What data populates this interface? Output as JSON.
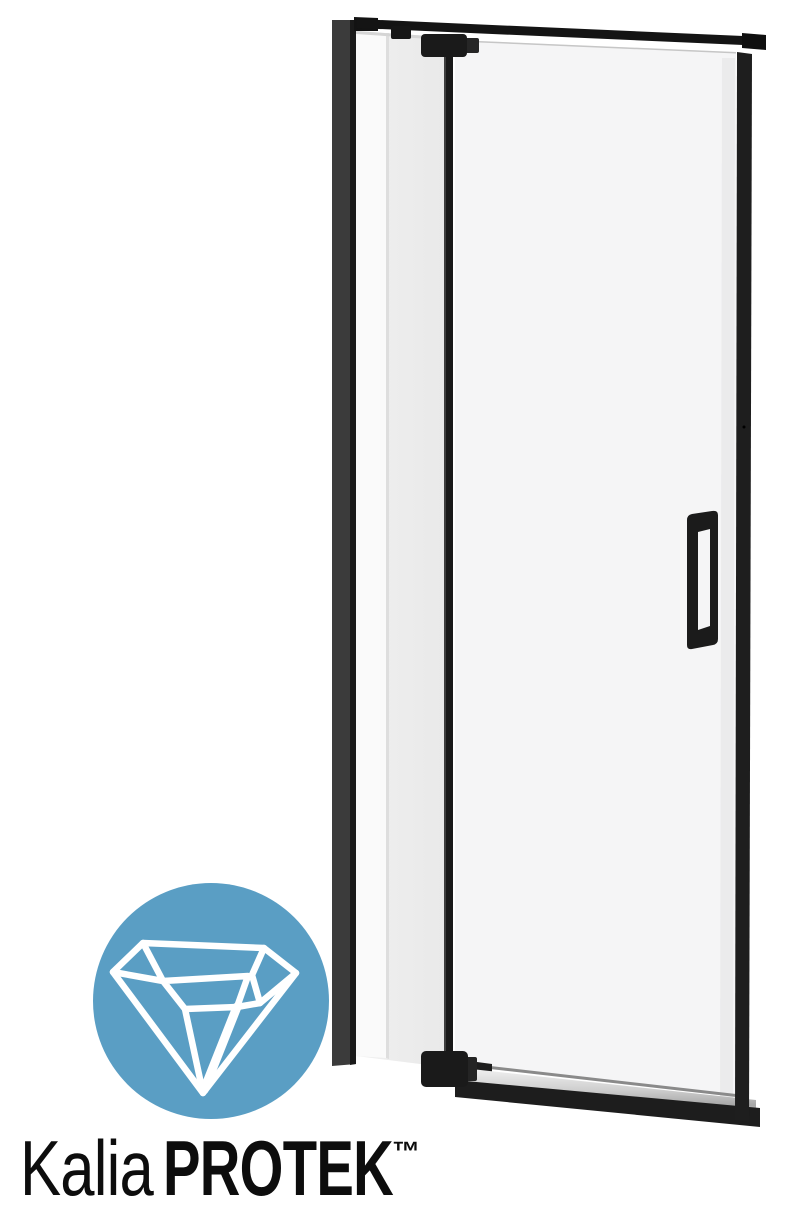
{
  "page": {
    "background": "#FFFFFF"
  },
  "brand": {
    "wordmark_regular": "Kalia",
    "wordmark_bold": "PROTEK",
    "trademark": "™"
  },
  "colors": {
    "background": "#FFFFFF",
    "frame_black": "#1E1E1E",
    "bar_black": "#141414",
    "hardware_black": "#1A1A1A",
    "handle_black": "#1B1B1B",
    "pivot_black": "#191919",
    "wall_profile_gray": "#3B3B3B",
    "door_glass": "#F5F5F6",
    "fixed_glass": "#ECECEC",
    "glass_highlight": "#FAFAFA",
    "threshold_black": "#1D1D1D",
    "badge_blue": "#5A9EC4",
    "icon_white": "#FFFFFF",
    "wordmark_black": "#0D0D0D"
  }
}
